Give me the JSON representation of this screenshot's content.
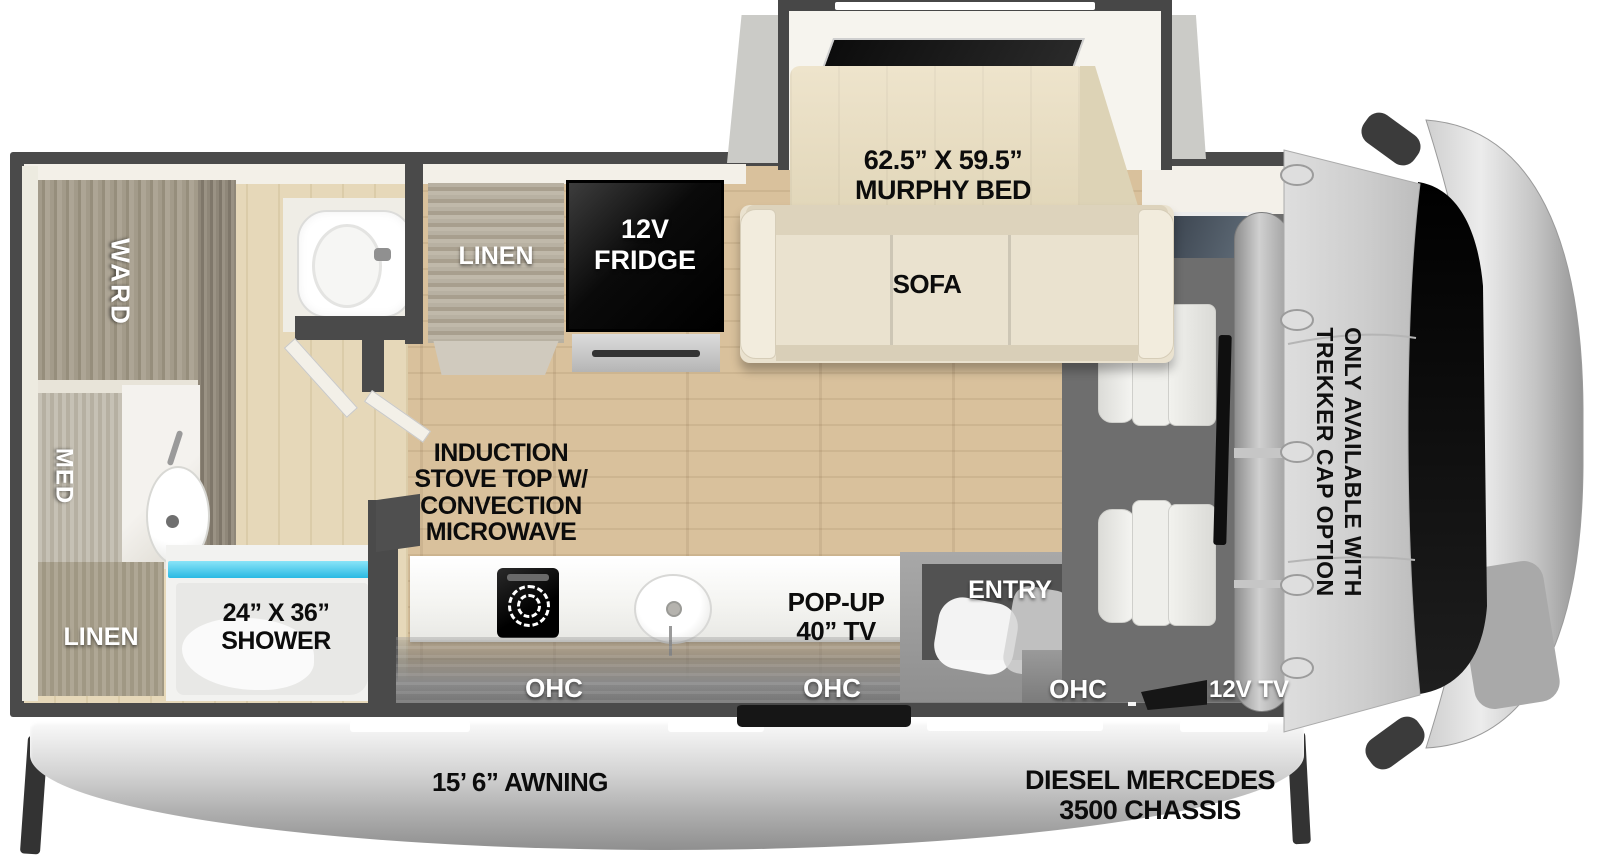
{
  "title": "RV floorplan diagram",
  "colors": {
    "wall": "#4a4a4a",
    "floor_main": "#d5bd97",
    "floor_bath": "#e0d2b4",
    "cabinet_wood": "#a69e8d",
    "counter_white": "#fbfbf9",
    "fridge_black": "#0d0d0d",
    "shower_glass": "#3cc6ec",
    "sofa_cream": "#eae2cf",
    "mattress_beige": "#e9dfc6",
    "awning_silver": "#c9c9c9",
    "cab_gray": "#cfcfcf",
    "windshield_black": "#0b0b0b",
    "label_light": "#ffffff",
    "label_dark": "#0c0c0c"
  },
  "labels": {
    "murphy_size": "62.5” X 59.5”",
    "murphy_name": "MURPHY BED",
    "sofa": "SOFA",
    "kitchen_linen": "LINEN",
    "fridge_line1": "12V",
    "fridge_line2": "FRIDGE",
    "ward": "WARD",
    "med": "MED",
    "bath_linen": "LINEN",
    "shower_size": "24” X 36”",
    "shower_name": "SHOWER",
    "stove_line1": "INDUCTION",
    "stove_line2": "STOVE TOP W/",
    "stove_line3": "CONVECTION",
    "stove_line4": "MICROWAVE",
    "popup_tv_line1": "POP-UP",
    "popup_tv_line2": "40” TV",
    "entry": "ENTRY",
    "ohc_left": "OHC",
    "ohc_mid": "OHC",
    "ohc_right": "OHC",
    "tv_12v": "12V TV",
    "trekker_line1": "ONLY AVAILABLE WITH",
    "trekker_line2": "TREKKER CAP OPTION",
    "awning": "15’ 6” AWNING",
    "chassis_line1": "DIESEL MERCEDES",
    "chassis_line2": "3500 CHASSIS"
  }
}
